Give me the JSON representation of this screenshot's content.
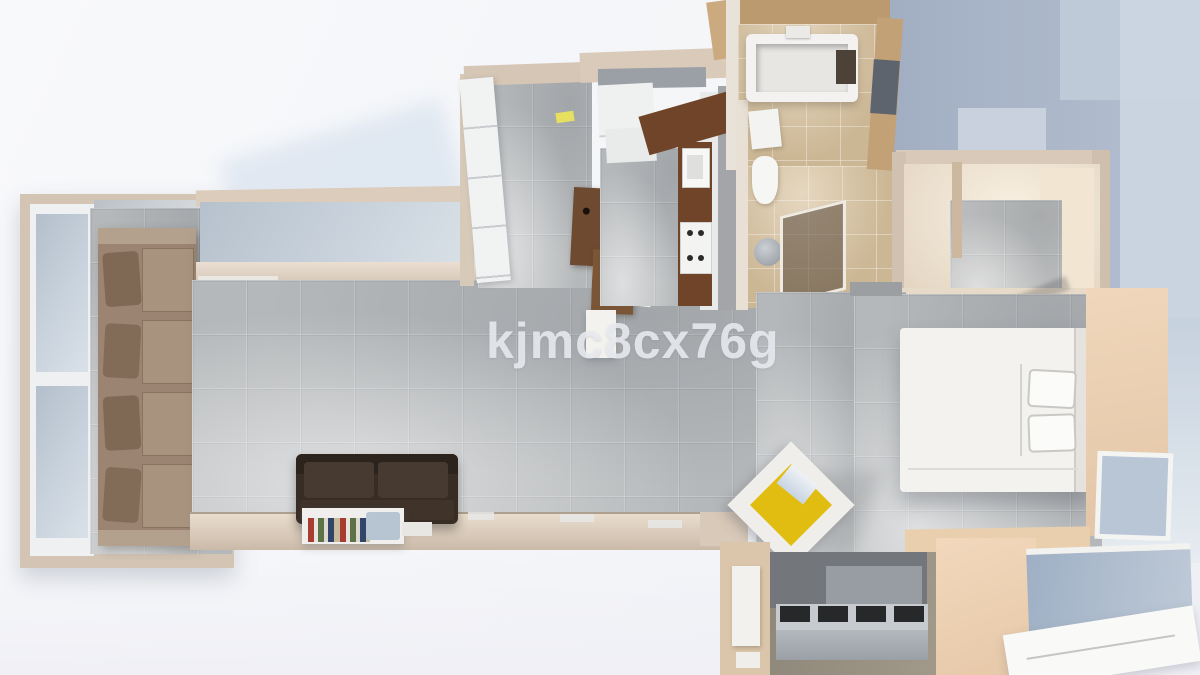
{
  "watermark": {
    "text": "kjmc8cx76g"
  },
  "scene": {
    "type": "3d-floor-plan-render-top-view",
    "rooms": [
      "living-room-bay",
      "living-room",
      "entry-hall",
      "kitchen",
      "bathroom",
      "walk-in-closet",
      "bedroom",
      "hallway",
      "balcony"
    ],
    "furniture": [
      "beige-sectional-sofa",
      "dining-table",
      "decor-sphere",
      "dark-leather-sofa",
      "book-sideboard",
      "wardrobe",
      "bar-counter",
      "kitchen-counter",
      "stove",
      "sink",
      "bathtub",
      "toilet",
      "washbasin",
      "shower",
      "double-bed",
      "pillows",
      "yellow-armchair",
      "storage-bench"
    ],
    "palette": {
      "wall_cream": "#d7c8b8",
      "floor_gray_tile": "#b5b8ba",
      "floor_tan_tile": "#ccb795",
      "background_blue": "#a8b4c6",
      "glass_blue": "#c6d1dd",
      "sofa_beige": "#9b8471",
      "sofa_dark_leather": "#372d25",
      "wood_brown": "#6f4428",
      "accent_yellow": "#e2bd11",
      "bed_white": "#f3f2ef",
      "bedroom_peach": "#ebd0b3",
      "balcony_floor": "#8f897c"
    }
  }
}
